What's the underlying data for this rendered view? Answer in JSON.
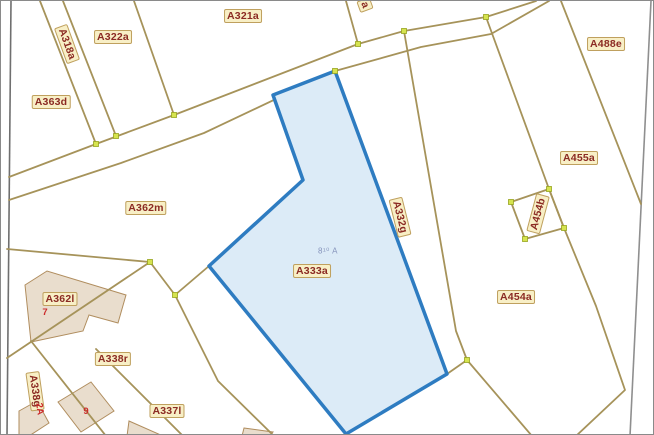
{
  "map": {
    "type": "cadastral-parcel-map",
    "selected_parcel": {
      "id": "A333a",
      "annotation": "8¹⁰ A"
    },
    "colors": {
      "highlight_stroke": "#2e7cc1",
      "highlight_fill": "#dcebf7",
      "parcel_line": "#a6935a",
      "label_bg": "#f8efc6",
      "label_text": "#8b2a23",
      "red_mark": "#cc2a2a",
      "vertex_marker": "#d6e34f",
      "building_fill": "#e9ddcd",
      "neatline": "#6f6f6f"
    },
    "parcel_labels": [
      {
        "text": "A318a"
      },
      {
        "text": "A322a"
      },
      {
        "text": "A321a"
      },
      {
        "text": "A363d"
      },
      {
        "text": "A488e"
      },
      {
        "text": "A455a"
      },
      {
        "text": "A362m"
      },
      {
        "text": "A332g"
      },
      {
        "text": "A454b"
      },
      {
        "text": "A333a"
      },
      {
        "text": "A454a"
      },
      {
        "text": "A362l"
      },
      {
        "text": "A338r"
      },
      {
        "text": "A338g"
      },
      {
        "text": "A337l"
      },
      {
        "text": "a"
      }
    ],
    "red_marks": [
      {
        "text": "7"
      },
      {
        "text": "2A"
      },
      {
        "text": "9"
      }
    ]
  }
}
